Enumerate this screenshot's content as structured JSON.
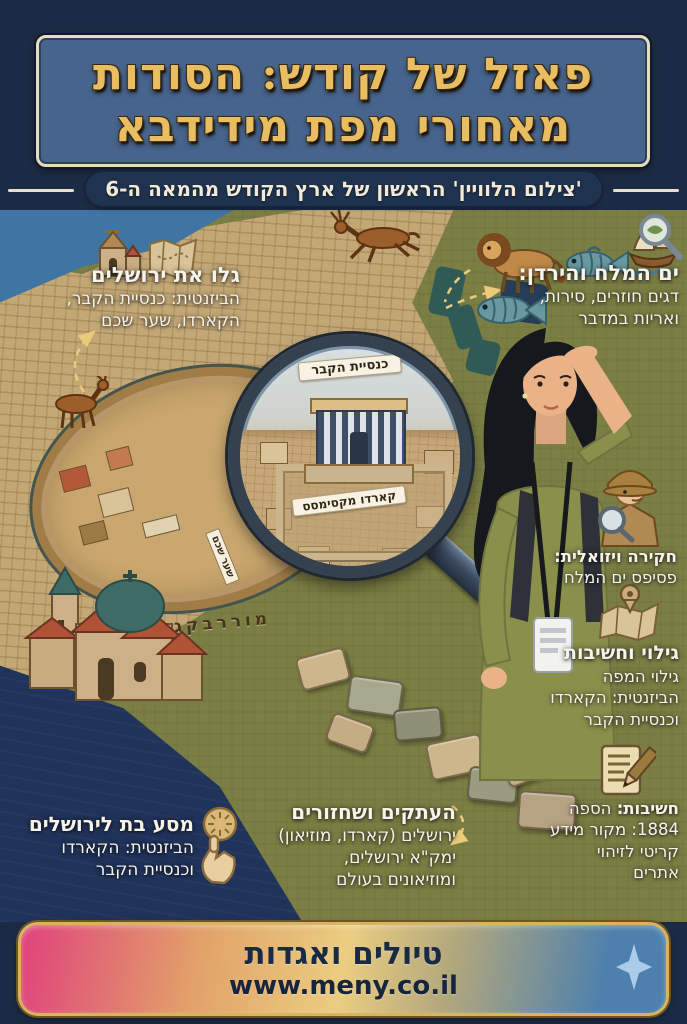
{
  "header": {
    "title_line1": "פאזל של קודש: הסודות",
    "title_line2": "מאחורי מפת מידידבא",
    "subtitle": "'צילום הלוויין' הראשון של ארץ הקודש מהמאה ה-6"
  },
  "annotations": {
    "jerusalem": {
      "title": "גלו את ירושלים",
      "lines": [
        "הביזנטית: כנסיית הקבר,",
        "הקארדו, שער שכם"
      ]
    },
    "dead_sea": {
      "title": "ים המלח והירדן:",
      "lines": [
        "דגים חוזרים, סירות,",
        "ואריות במדבר"
      ]
    },
    "visual_inquiry": {
      "lines": [
        "חקירה ויזואלית:",
        "פסיפס ים המלח"
      ]
    },
    "discovery": {
      "title": "גילוי וחשיבות",
      "lines": [
        "גילוי המפה",
        "הביזנטית: הקארדו",
        "וכנסיית הקבר"
      ]
    },
    "importance": {
      "title_bold": "חשיבות:",
      "title_rest": "הספה",
      "lines": [
        "1884: מקור מידע",
        "קריטי לזיהוי",
        "אתרים"
      ]
    },
    "journey": {
      "title": "מסע בת לירושלים",
      "lines": [
        "הביזנטית: הקארדו",
        "וכנסיית הקבר"
      ]
    },
    "replicas": {
      "title": "העתקים ושחזורים",
      "lines": [
        "ירושלים (קארדו, מוזיאון)",
        "ימק\"א ירושלים,",
        "ומוזיאונים בעולם"
      ]
    }
  },
  "map_labels": {
    "magnifier_top": "כנסיית הקבר",
    "magnifier_mid": "קארדו מקסימסס",
    "street_sign": "שער שכם",
    "mosaic_inscription": "מוררבקגול"
  },
  "footer": {
    "title": "טיולים ואגדות",
    "url": "www.meny.co.il"
  },
  "icons": {
    "church": "⛪",
    "map_scroll": "🗺",
    "lion": "🦁",
    "fish": "🐟",
    "boat": "⛵",
    "magnifier": "🔍",
    "detective": "🕵",
    "map_pin": "📍",
    "note": "📝",
    "pointing_hand": "☝",
    "deer": "🦌",
    "sparkle": "✦"
  },
  "colors": {
    "background_navy": "#1c2b45",
    "panel_blue": "#47648c",
    "title_gold": "#e9bd62",
    "cream": "#f2ead6",
    "olive": "#7c7f44",
    "mosaic_tan": "#c3a876",
    "sea_blue": "#3f74a3",
    "deep_navy": "#20335a",
    "banner_pink": "#e0427c",
    "banner_gold": "#eacd80",
    "banner_blue": "#4d80ad"
  }
}
